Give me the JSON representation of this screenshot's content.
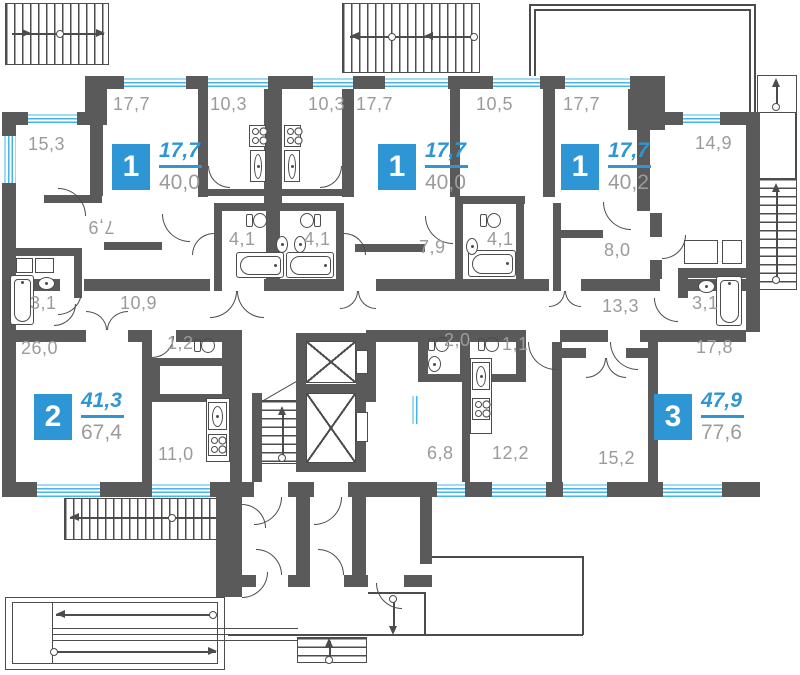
{
  "colors": {
    "wall": "#5a5a5a",
    "line": "#4c4c4c",
    "accent": "#2e96d5",
    "window": "#45b5e9",
    "label": "#9b9b9b",
    "background": "#ffffff"
  },
  "apartments": [
    {
      "number": "1",
      "living_area": "17,7",
      "total_area": "40,0"
    },
    {
      "number": "1",
      "living_area": "17,7",
      "total_area": "40,0"
    },
    {
      "number": "1",
      "living_area": "17,7",
      "total_area": "40,2"
    },
    {
      "number": "2",
      "living_area": "41,3",
      "total_area": "67,4"
    },
    {
      "number": "3",
      "living_area": "47,9",
      "total_area": "77,6"
    }
  ],
  "rooms": [
    {
      "area": "15,3"
    },
    {
      "area": "17,7"
    },
    {
      "area": "10,3"
    },
    {
      "area": "10,3"
    },
    {
      "area": "17,7"
    },
    {
      "area": "10,5"
    },
    {
      "area": "17,7"
    },
    {
      "area": "14,9"
    },
    {
      "area": "7,9"
    },
    {
      "area": "4,1"
    },
    {
      "area": "4,1"
    },
    {
      "area": "7,9"
    },
    {
      "area": "4,1"
    },
    {
      "area": "8,0"
    },
    {
      "area": "10,9"
    },
    {
      "area": "13,3"
    },
    {
      "area": "3,1"
    },
    {
      "area": "3,1"
    },
    {
      "area": "26,0"
    },
    {
      "area": "1,2"
    },
    {
      "area": "2,0"
    },
    {
      "area": "1,1"
    },
    {
      "area": "17,8"
    },
    {
      "area": "11,0"
    },
    {
      "area": "6,8"
    },
    {
      "area": "12,2"
    },
    {
      "area": "15,2"
    }
  ]
}
